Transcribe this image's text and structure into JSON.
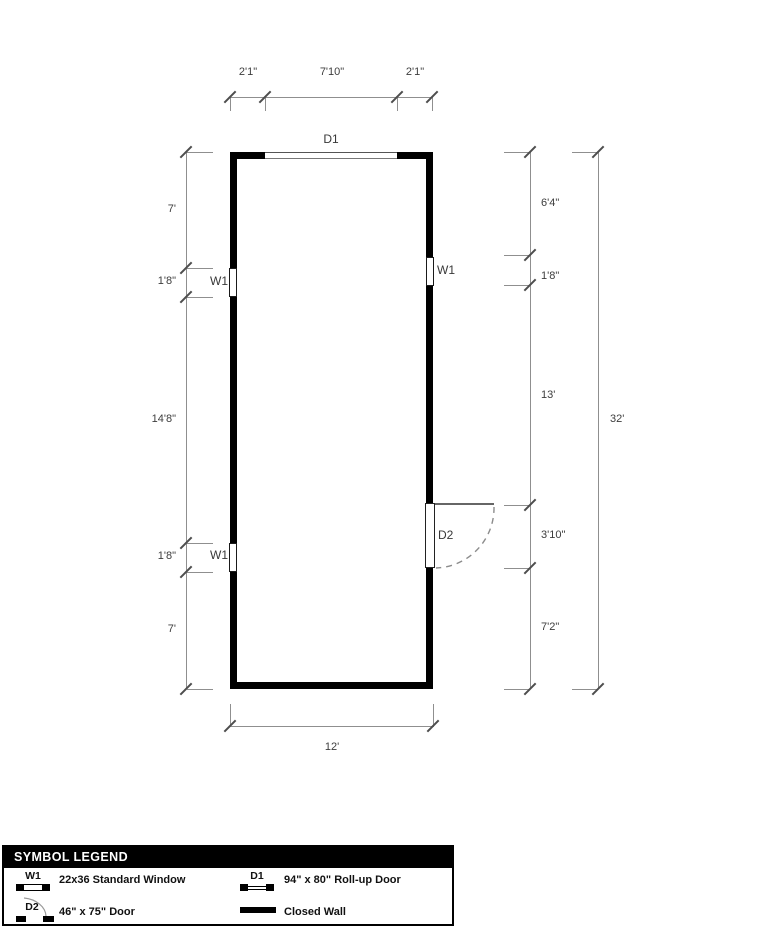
{
  "plan": {
    "rollup_door_label": "D1",
    "window_label": "W1",
    "door_label": "D2",
    "dim_top": [
      "2'1\"",
      "7'10\"",
      "2'1\""
    ],
    "dim_left": [
      "7'",
      "1'8\"",
      "14'8\"",
      "1'8\"",
      "7'"
    ],
    "dim_right": [
      "6'4\"",
      "1'8\"",
      "13'",
      "3'10\"",
      "7'2\""
    ],
    "dim_right_total": "32'",
    "dim_bottom": "12'"
  },
  "legend": {
    "title": "SYMBOL LEGEND",
    "items": [
      {
        "code": "W1",
        "label": "22x36 Standard Window"
      },
      {
        "code": "D1",
        "label": "94\" x 80\" Roll-up Door"
      },
      {
        "code": "D2",
        "label": "46\" x 75\" Door"
      },
      {
        "code": "",
        "label": "Closed Wall"
      }
    ]
  }
}
